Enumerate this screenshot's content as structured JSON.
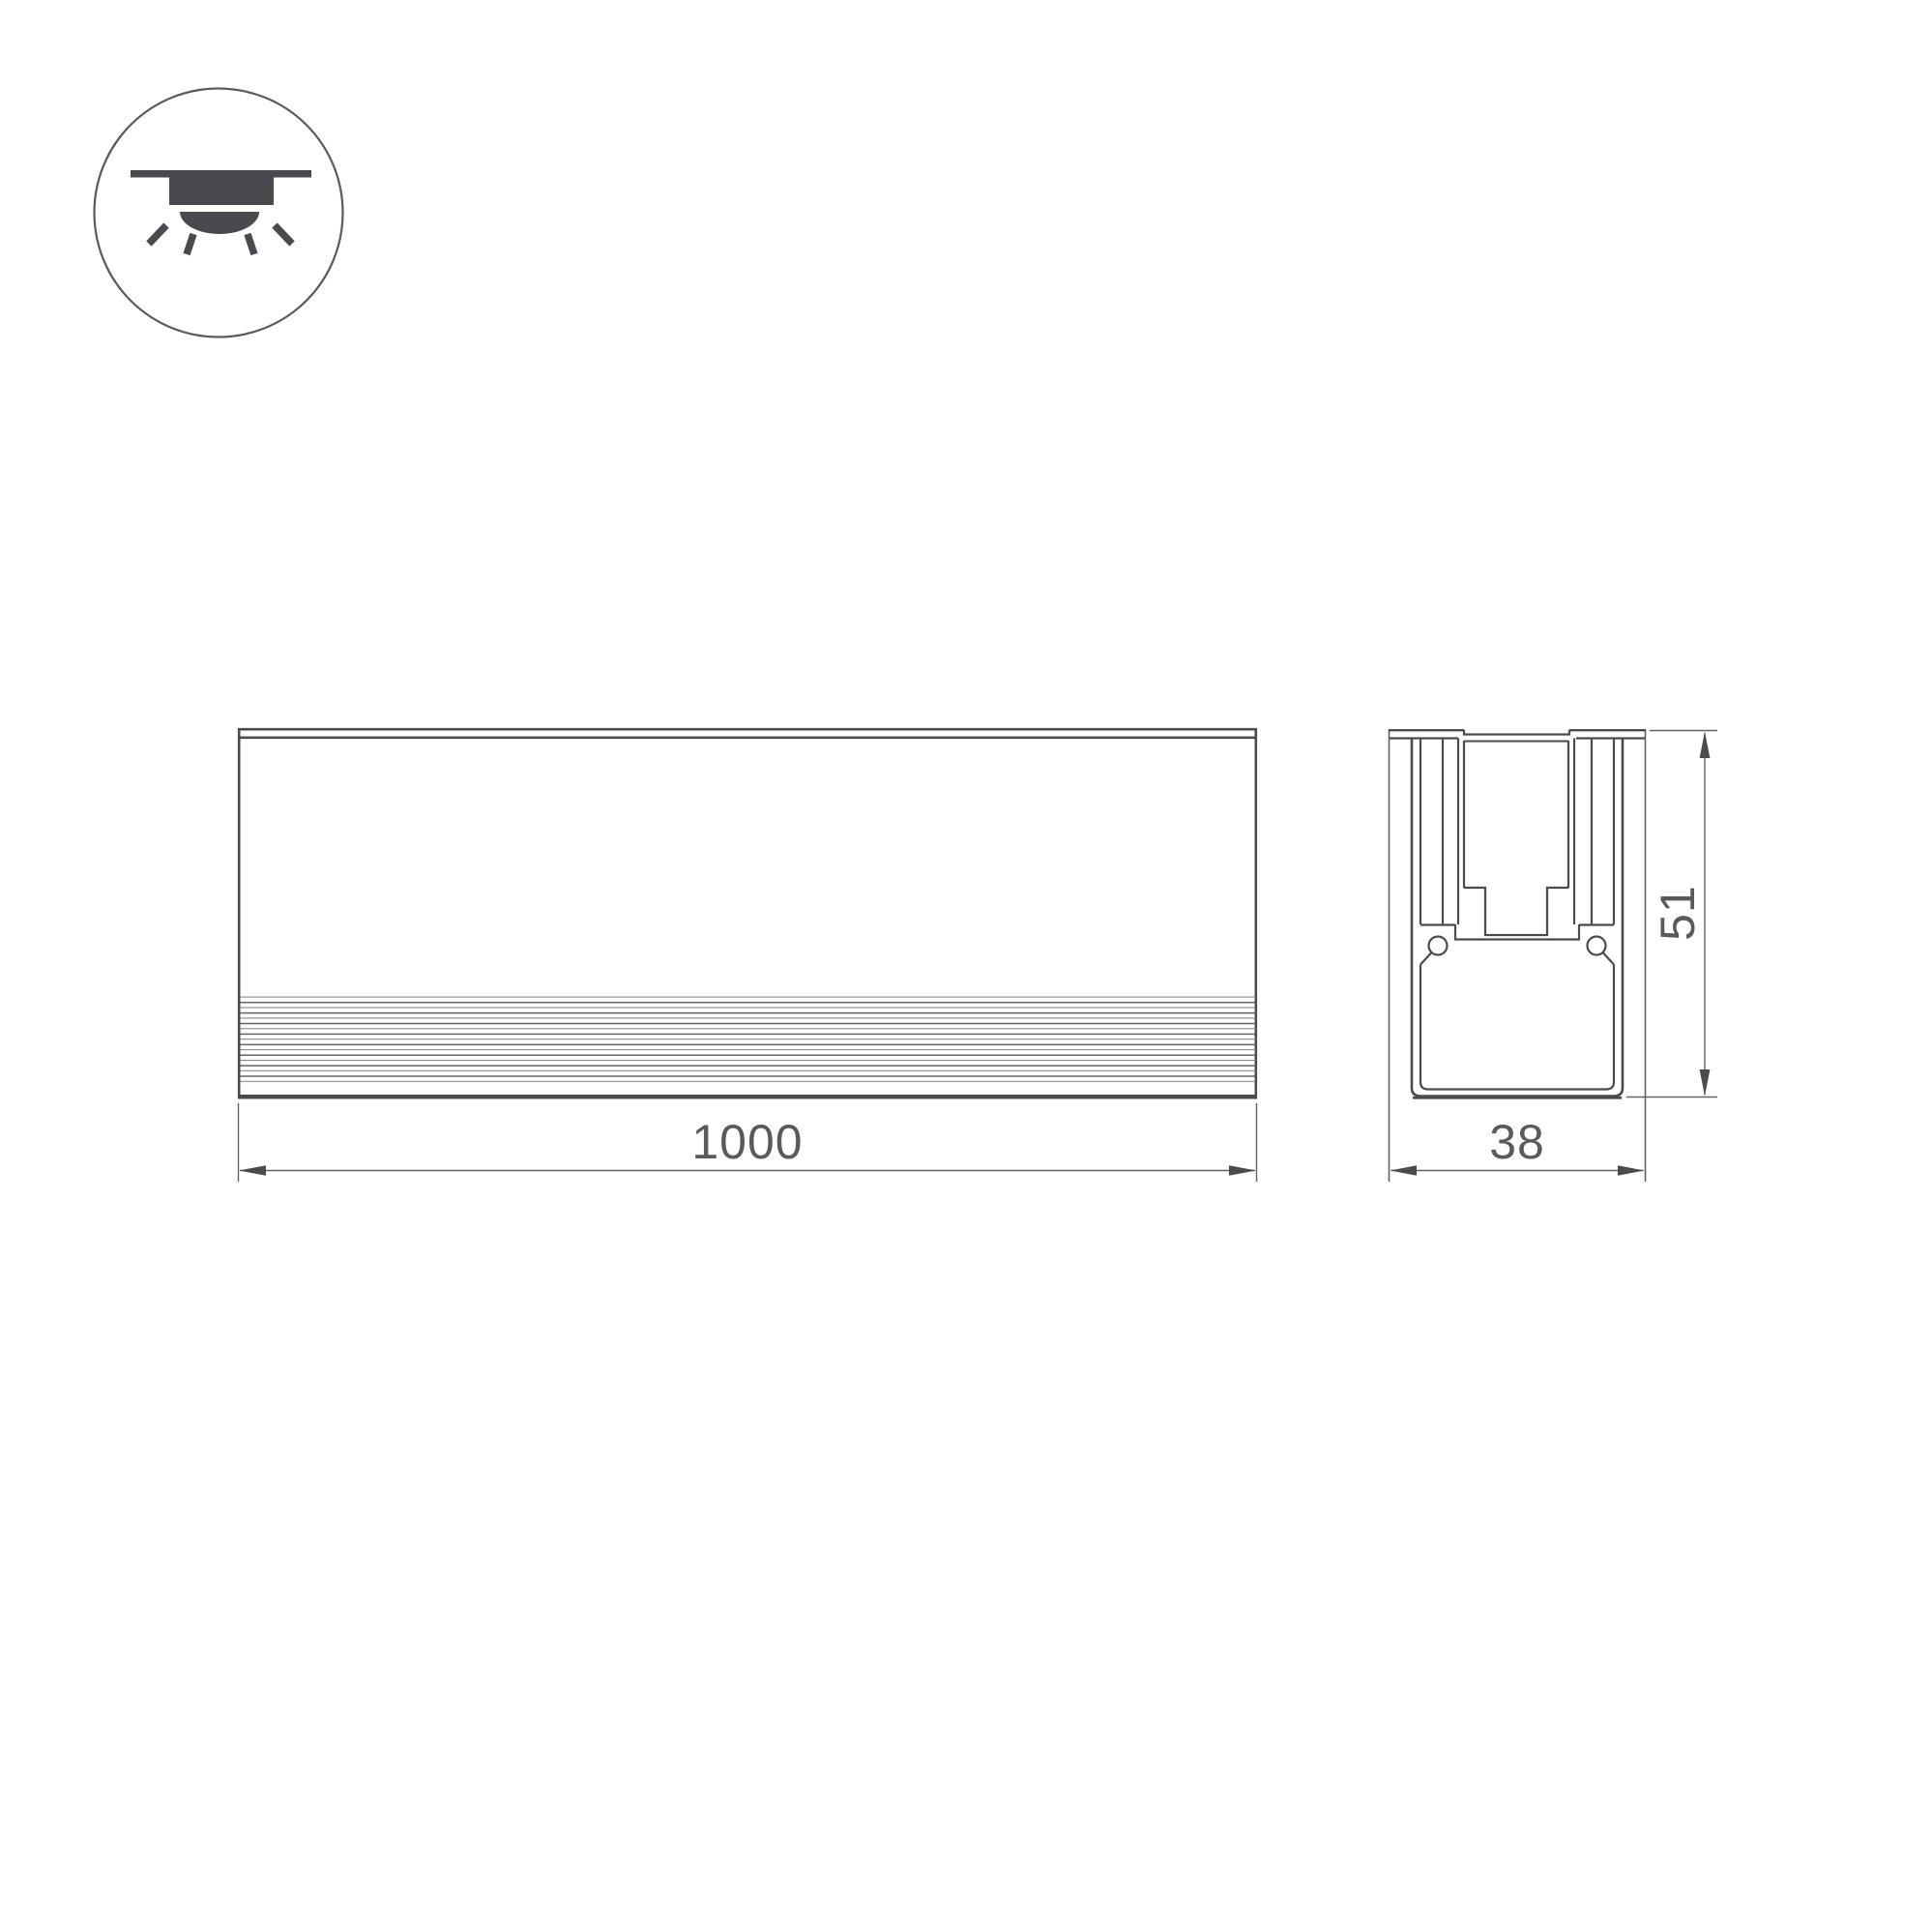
{
  "drawing": {
    "type": "technical-drawing-led-profile",
    "icon": "recessed-downlight",
    "dimensions": {
      "length": "1000",
      "width": "38",
      "height": "51"
    }
  },
  "colors": {
    "line": "#4b4b4e",
    "thin_line": "#636366",
    "rib_line": "#87878a",
    "text": "#5a5a5d",
    "background": "#ffffff"
  }
}
